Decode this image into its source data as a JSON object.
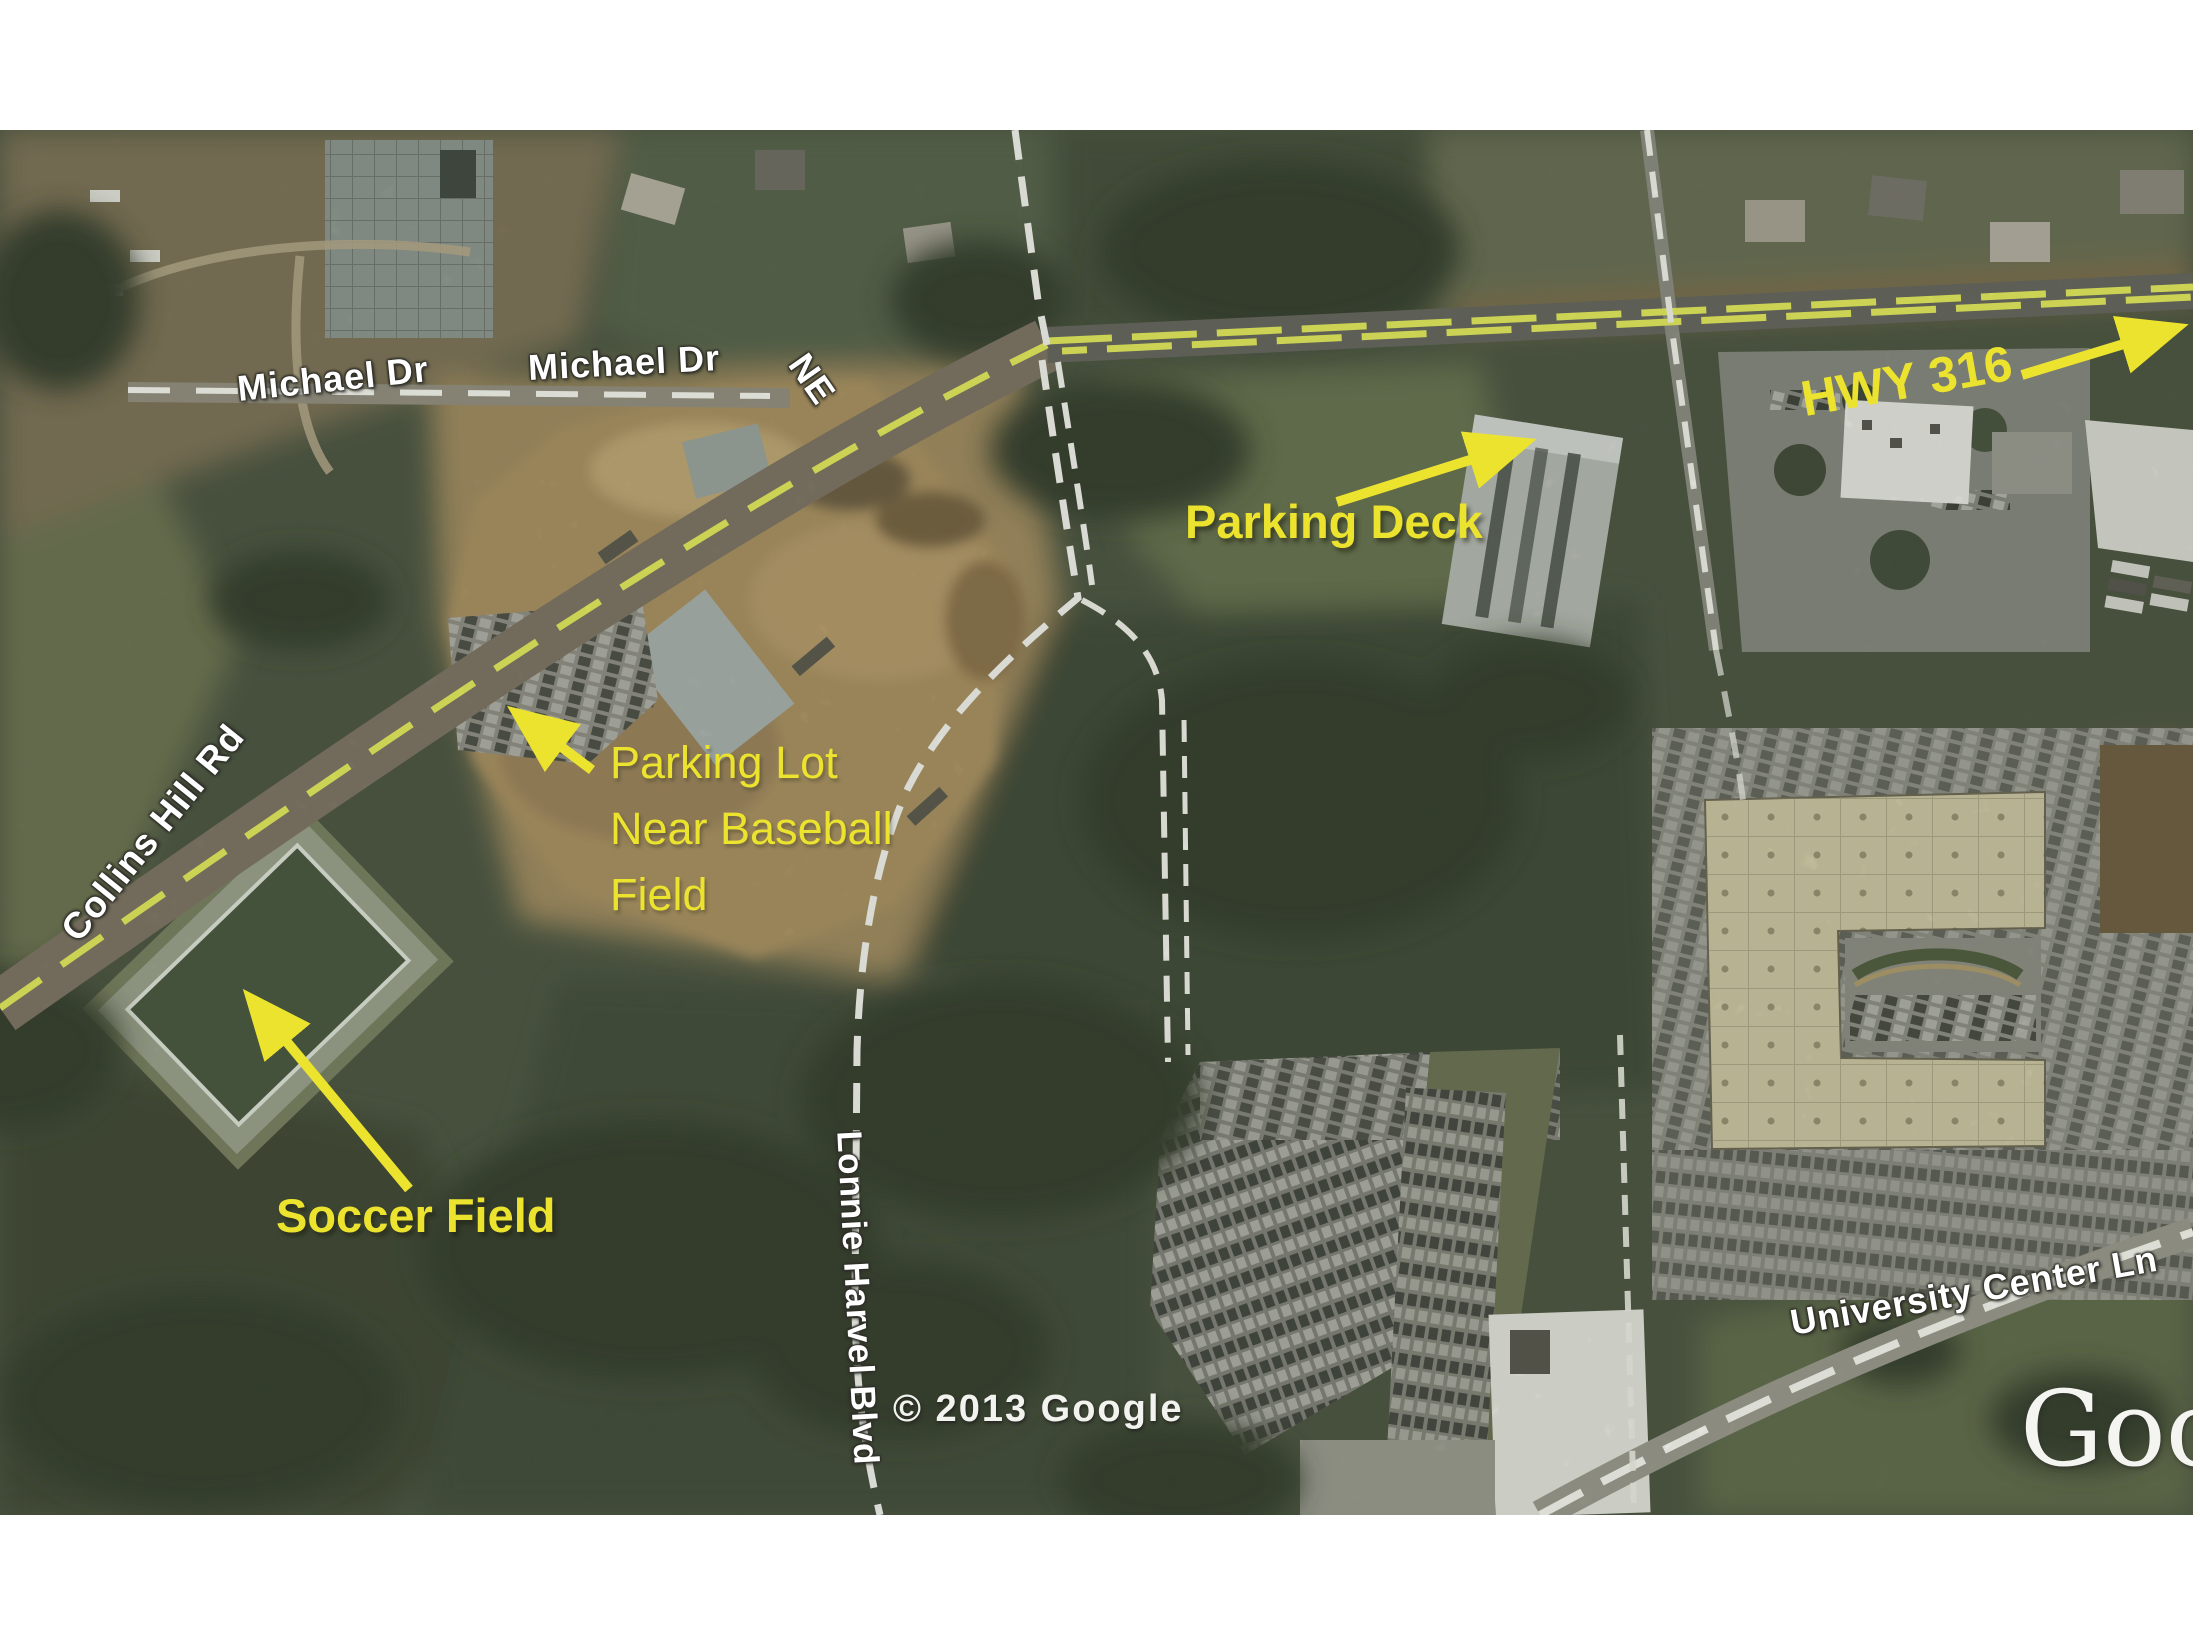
{
  "map": {
    "road_labels": {
      "michael_dr": "Michael Dr",
      "michael_dr_ne": "Michael Dr",
      "michael_dr_ne_suffix": "NE",
      "collins_hill_rd": "Collins Hill Rd",
      "lonnie_harvel_blvd": "Lonnie Harvel Blvd",
      "university_center_ln": "University Center Ln"
    },
    "annotations": {
      "hwy_316": "HWY 316",
      "parking_deck": "Parking Deck",
      "parking_lot_line1": "Parking Lot",
      "parking_lot_line2": "Near Baseball",
      "parking_lot_line3": "Field",
      "soccer_field": "Soccer Field"
    },
    "attribution": "© 2013 Google",
    "watermark": "Google",
    "colors": {
      "annotation_yellow": "#ece32f",
      "road_label_white": "#ffffff",
      "highway_dash_yellow": "#e8ee5a"
    }
  }
}
